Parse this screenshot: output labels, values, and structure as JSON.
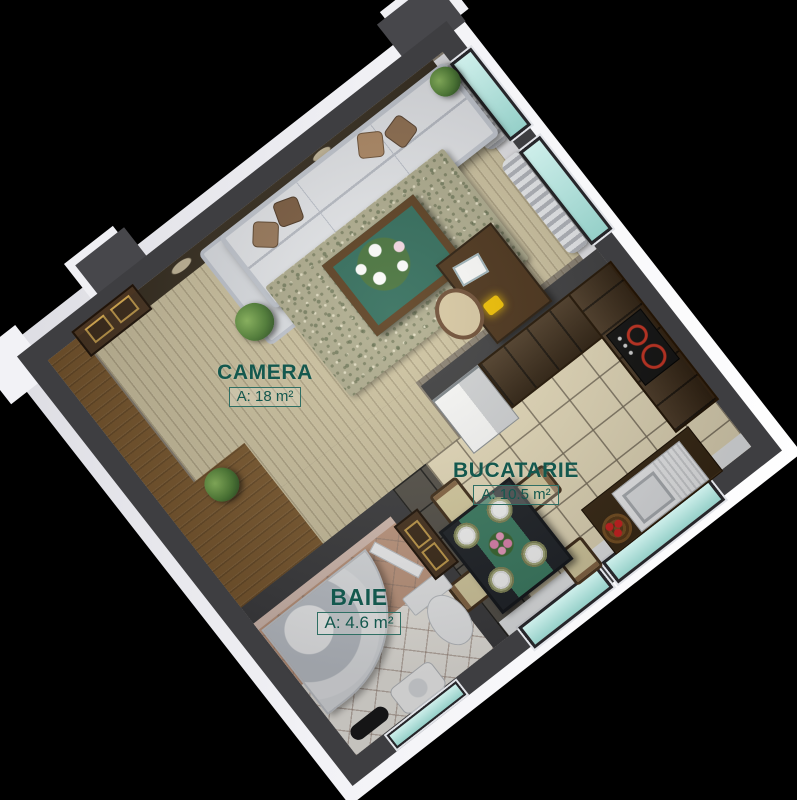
{
  "scene": {
    "description": "3D rendered one-bedroom apartment floor plan viewed from above, rotated, on a black background",
    "background_color": "#000000"
  },
  "rooms": [
    {
      "id": "camera",
      "name": "CAMERA",
      "area": "A: 18 m²"
    },
    {
      "id": "bucatarie",
      "name": "BUCATARIE",
      "area": "A: 10.5 m²"
    },
    {
      "id": "baie",
      "name": "BAIE",
      "area": "A: 4.6 m²"
    }
  ],
  "palette": {
    "label_text": "#14584E",
    "label_box_border": "#2F6F64",
    "wall_cut_top": "#3E3E41",
    "wall_outer_white": "#F2F2F6",
    "window_glass_teal": "#A9DCD6",
    "parquet_light": "#D0C5A3",
    "wood_gray": "#8A8173",
    "entry_wood_brown": "#7D5A30",
    "kitchen_tile_cream": "#EADFBF",
    "tile_dark": "#55514B",
    "cabinet_wood": "#412D18",
    "burner_red": "#CC3322",
    "sofa_gray_white": "#E7E9EE",
    "rug_green": "#B0AD90"
  }
}
